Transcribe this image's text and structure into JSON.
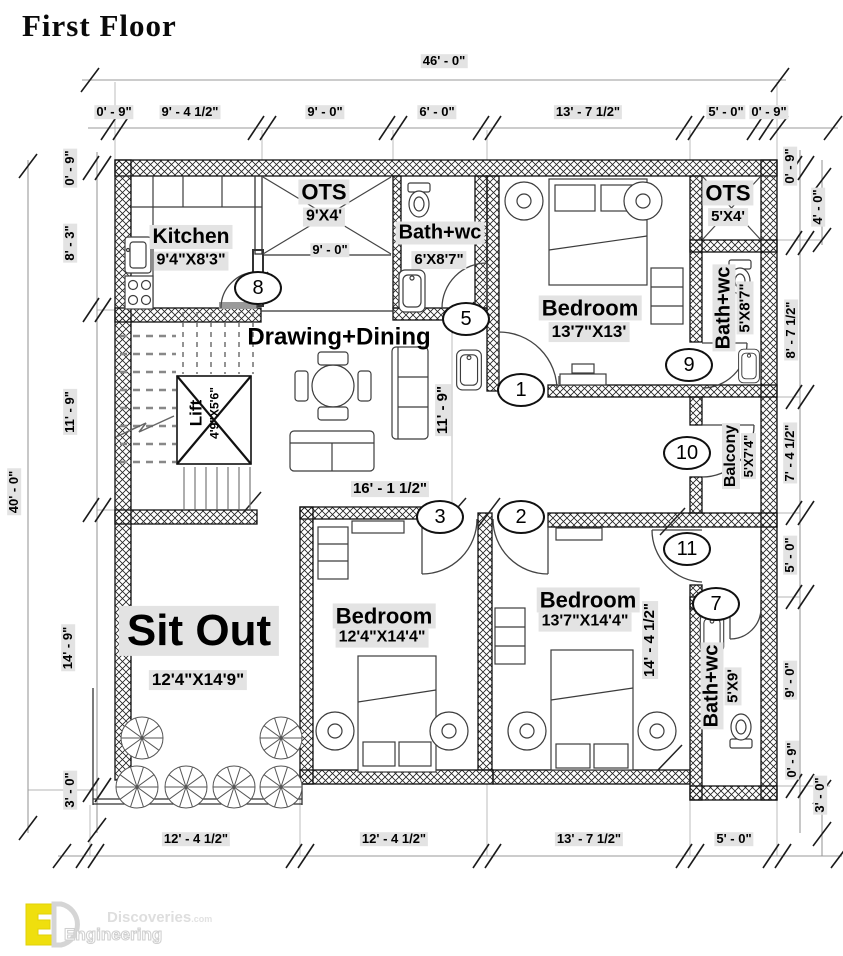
{
  "title": "First Floor",
  "colors": {
    "accent_yellow": "#efdf0e",
    "label_bg": "#e3e3e3",
    "line": "#000000",
    "dim_line": "#999999"
  },
  "dims": {
    "top_overall": "46' - 0\"",
    "top": [
      "0' - 9\"",
      "9' - 4 1/2\"",
      "9' - 0\"",
      "6' - 0\"",
      "13' - 7 1/2\"",
      "5' - 0\"",
      "0' - 9\""
    ],
    "bottom": [
      "12' - 4 1/2\"",
      "12' - 4 1/2\"",
      "13' - 7 1/2\"",
      "5' - 0\""
    ],
    "left_overall": "40' - 0\"",
    "left": [
      "0' - 9\"",
      "8' - 3\"",
      "11' - 9\"",
      "14' - 9\"",
      "3' - 0\""
    ],
    "right": [
      "0' - 9\"",
      "4' - 0\"",
      "8' - 7 1/2\"",
      "7' - 4 1/2\"",
      "5' - 0\"",
      "9' - 0\"",
      "0' - 9\"",
      "3' - 0\""
    ],
    "ots_width": "9' - 0\"",
    "drawing_width": "16' - 1 1/2\"",
    "drawing_height": "11' - 9\"",
    "bedroom3_height": "14' - 4 1/2\""
  },
  "rooms": {
    "kitchen": {
      "name": "Kitchen",
      "size": "9'4\"X8'3\""
    },
    "ots1": {
      "name": "OTS",
      "size": "9'X4'"
    },
    "bath1": {
      "name": "Bath+wc",
      "size": "6'X8'7\""
    },
    "bedroom1": {
      "name": "Bedroom",
      "size": "13'7\"X13'"
    },
    "ots2": {
      "name": "OTS",
      "size": "5'X4'"
    },
    "bath2": {
      "name": "Bath+wc",
      "size": "5'X8'7\""
    },
    "drawing": {
      "name": "Drawing+Dining"
    },
    "lift": {
      "name": "Lift",
      "size": "4'9\"X5'6\""
    },
    "balcony": {
      "name": "Balcony",
      "size": "5'X7'4\""
    },
    "sitout": {
      "name": "Sit Out",
      "size": "12'4\"X14'9\""
    },
    "bedroom2": {
      "name": "Bedroom",
      "size": "12'4\"X14'4\""
    },
    "bedroom3": {
      "name": "Bedroom",
      "size": "13'7\"X14'4\""
    },
    "bath3": {
      "name": "Bath+wc",
      "size": "5'X9'"
    }
  },
  "markers": [
    "8",
    "5",
    "1",
    "9",
    "10",
    "3",
    "2",
    "11",
    "7"
  ],
  "logo": {
    "brand": "Discoveries",
    "brand_suffix": ".com",
    "brand2": "Engineering"
  }
}
